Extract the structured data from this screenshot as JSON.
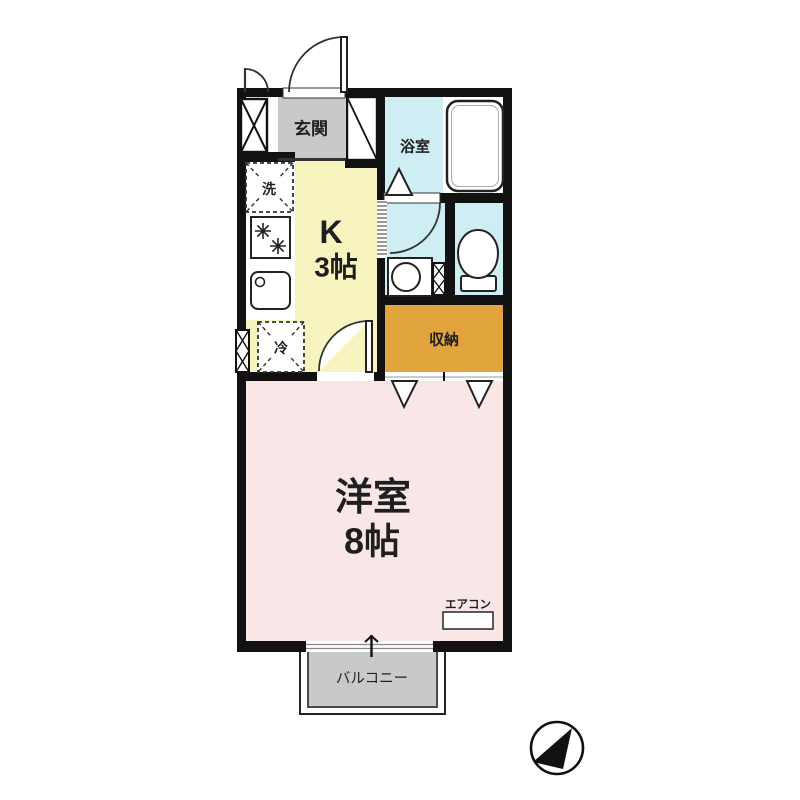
{
  "title": "1K apartment floor plan",
  "floorplan": {
    "genkan": {
      "label": "玄関"
    },
    "bathroom": {
      "label": "浴室"
    },
    "kitchen": {
      "name": "K",
      "size": "3帖"
    },
    "storage": {
      "label": "収納"
    },
    "western_room": {
      "name": "洋室",
      "size": "8帖"
    },
    "balcony": {
      "label": "バルコニー"
    },
    "washer": {
      "label": "洗"
    },
    "fridge": {
      "label": "冷"
    },
    "aircon": {
      "label": "エアコン"
    },
    "compass": {
      "icon": "north-arrow",
      "direction": "northeast"
    },
    "colors": {
      "wall": "#111111",
      "genkan": "#c9c9c9",
      "kitchen": "#f8f4bf",
      "wet_area": "#cfeef3",
      "storage": "#e2a43c",
      "room": "#f9e7e7",
      "balcony": "#c9c9c9"
    }
  }
}
